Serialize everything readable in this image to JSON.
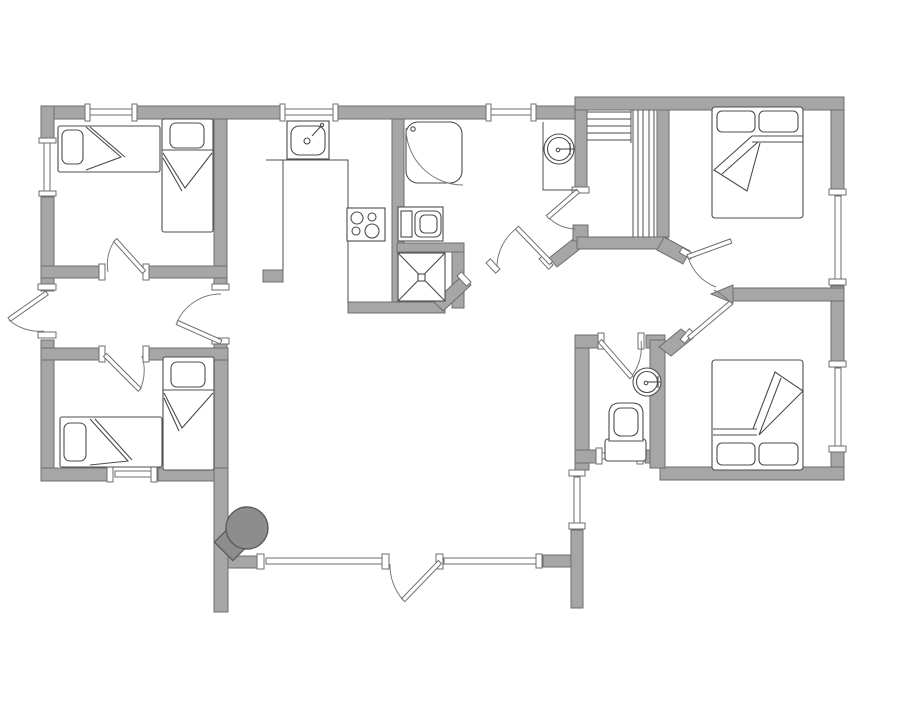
{
  "document": {
    "type": "architectural-floor-plan",
    "title": "holiday-house-floor-plan",
    "canvas_width": 903,
    "canvas_height": 714
  },
  "colors": {
    "background": "#ffffff",
    "wall_fill": "#a6a6a6",
    "wall_stroke": "#6e6e6e",
    "furniture_line": "#4c4c4c",
    "door_arc": "#7a7a7a",
    "fireplace_fill": "#8d8d8d",
    "fireplace_stroke": "#5c5c5c"
  },
  "inventory": {
    "rooms": [
      "bedroom-top-left-two-single-beds",
      "bedroom-bottom-left-two-single-beds",
      "bedroom-top-right-double-bed",
      "bedroom-bottom-right-double-bed",
      "kitchen-open-plan",
      "bathroom-with-shower-and-washing-machine",
      "sauna-with-benches",
      "wc-with-toilet-and-basin",
      "living-room-with-wood-stove",
      "entry-hall-with-four-doors"
    ],
    "fixtures": [
      "single-bed x4",
      "double-bed x2",
      "kitchen-sink",
      "stove-4-burners",
      "corner-shower",
      "washing-machine",
      "floor-unit-x-box",
      "round-washbasin x2",
      "toilet",
      "sauna-bench x2",
      "wood-stove-fireplace"
    ],
    "doors": 10,
    "windows": 11
  }
}
